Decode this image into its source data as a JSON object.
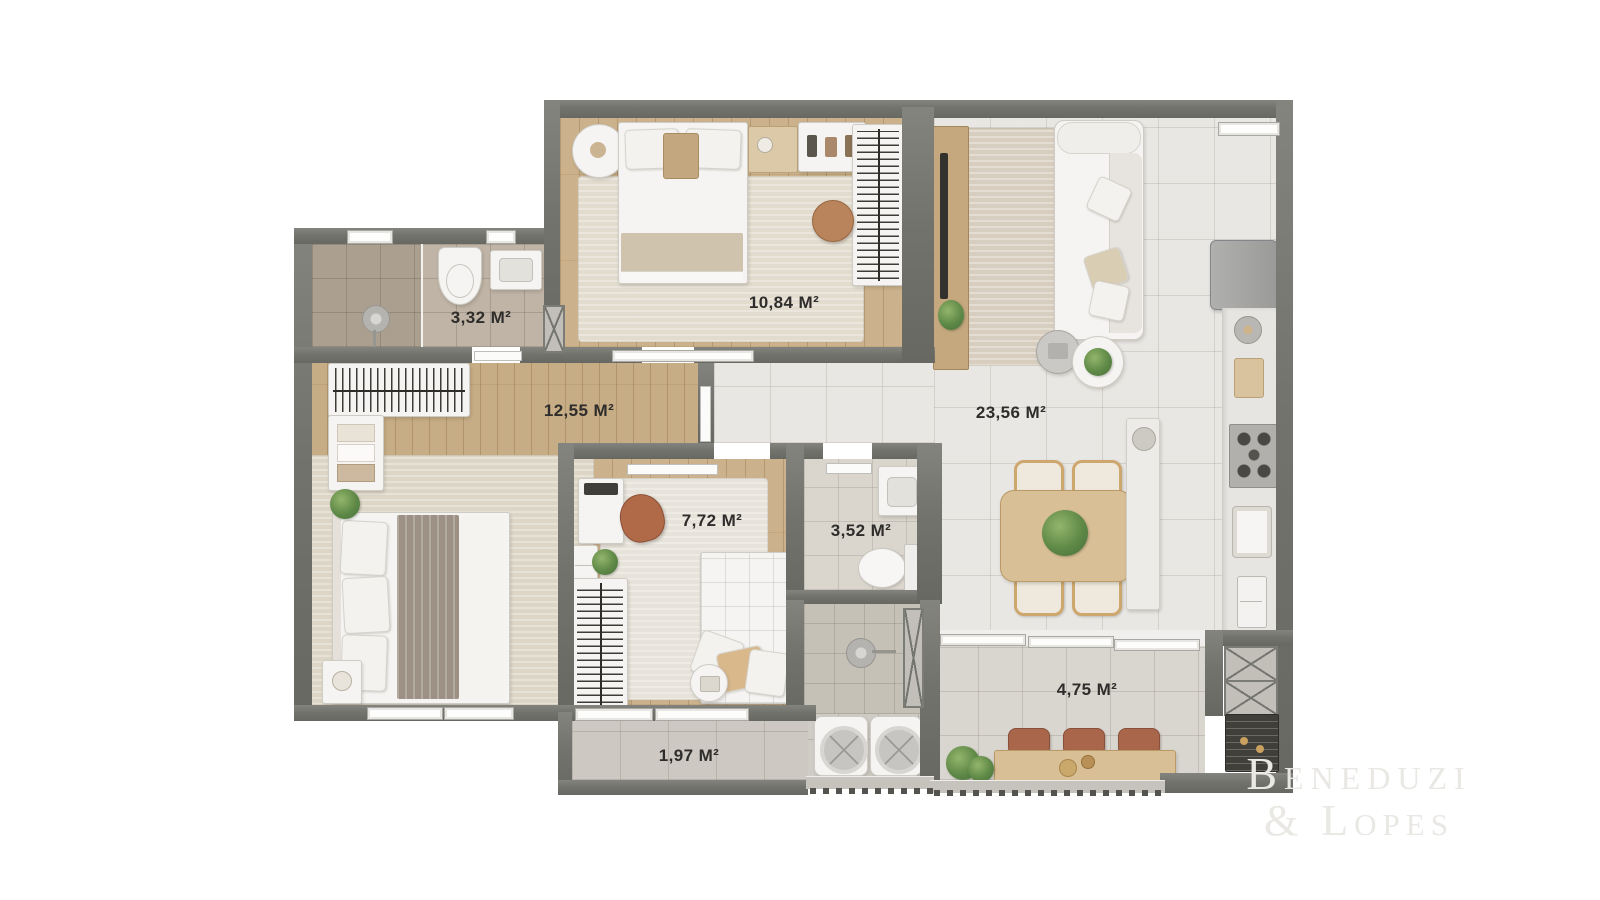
{
  "plan": {
    "labels": {
      "bathroom_suite": "3,32 M²",
      "master_bedroom": "10,84 M²",
      "bedroom": "12,55 M²",
      "living_dining": "23,56 M²",
      "office": "7,72 M²",
      "bathroom": "3,52 M²",
      "gourmet_balcony": "4,75 M²",
      "service_balcony": "1,97 M²"
    }
  },
  "watermark": {
    "line1": "Beneduzi",
    "line2": "& Lopes"
  },
  "colors": {
    "wall": "#73736d",
    "wood_floor": "#cbb28c",
    "tile_floor": "#e9e7e3",
    "bath_tile": "#bfb4a5",
    "label_text": "#2e2d2b",
    "watermark_text": "#e9e8e4",
    "terracotta_accent": "#a9664a",
    "plant_green": "#5f8947"
  }
}
